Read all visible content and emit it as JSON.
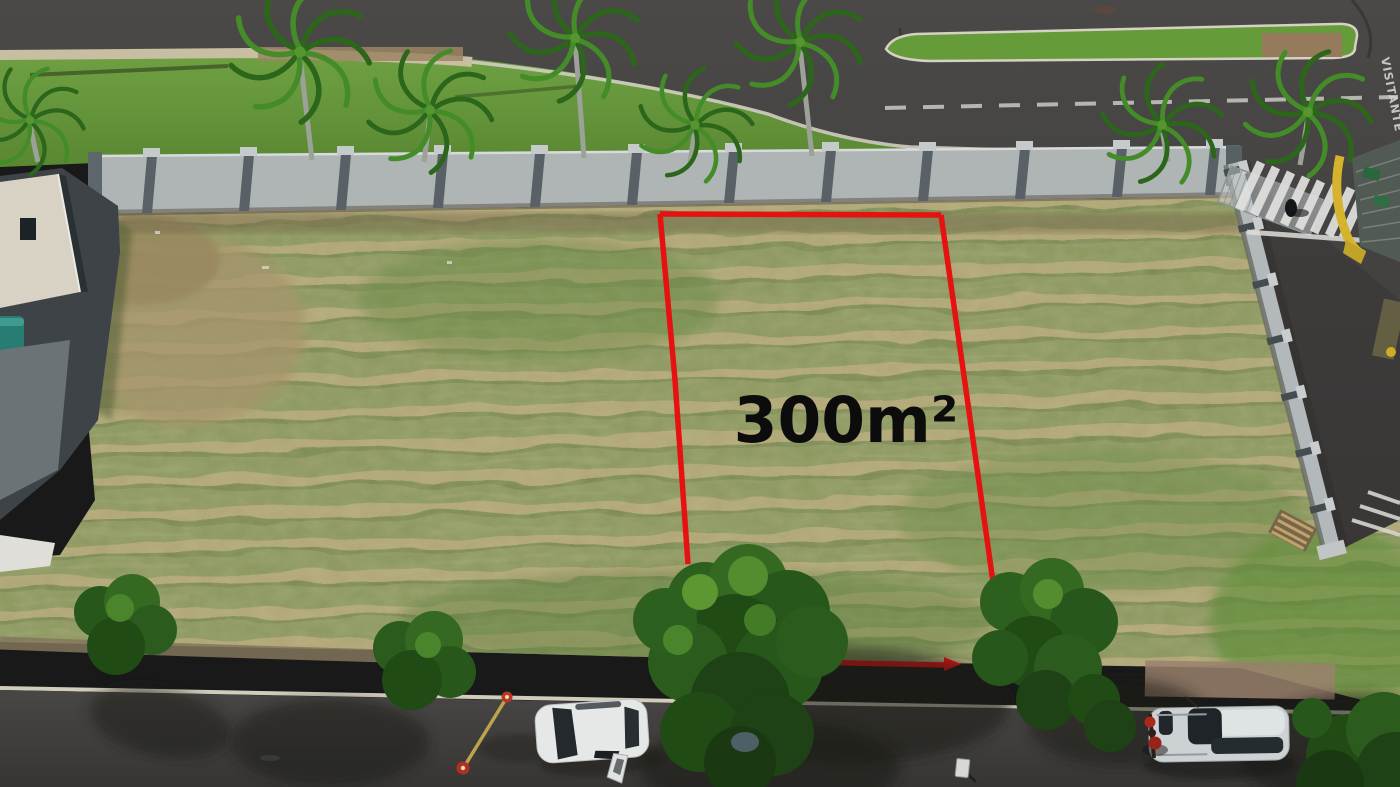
{
  "meta": {
    "width": 1400,
    "height": 787,
    "kind": "aerial-drone-photo-of-vacant-lot"
  },
  "annotation": {
    "area_label": "300m²",
    "boundary_color": "#ee1313",
    "label_color": "#0d0d0d"
  },
  "road_markings": {
    "lane_text": "VISITANTE",
    "lane_text_color": "#dcdad2",
    "center_line_style": "dashed-white"
  },
  "palette": {
    "asphalt": "#4a4846",
    "field_green": "#8e9a60",
    "dry_row_tan": "#b9ab7a",
    "verge_green": "#6ba03e",
    "wall_gray": "#b5babb",
    "tree_green": "#2f6320",
    "guardhouse_yellow": "#ddb92e",
    "pool_teal": "#2a8276"
  },
  "objects": {
    "vehicles": [
      "white-hatchback-open-door",
      "silver-suv",
      "red-motorcycle"
    ],
    "street_furniture": [
      "survey-pole-with-cones",
      "small-street-sign"
    ],
    "structures": [
      "perimeter-wall",
      "entrance-gate",
      "guardhouse",
      "crosswalk",
      "house-with-pool"
    ],
    "vegetation": [
      "royal-palm-trees",
      "street-trees",
      "mowed-vacant-lot",
      "grass-median-island"
    ]
  }
}
